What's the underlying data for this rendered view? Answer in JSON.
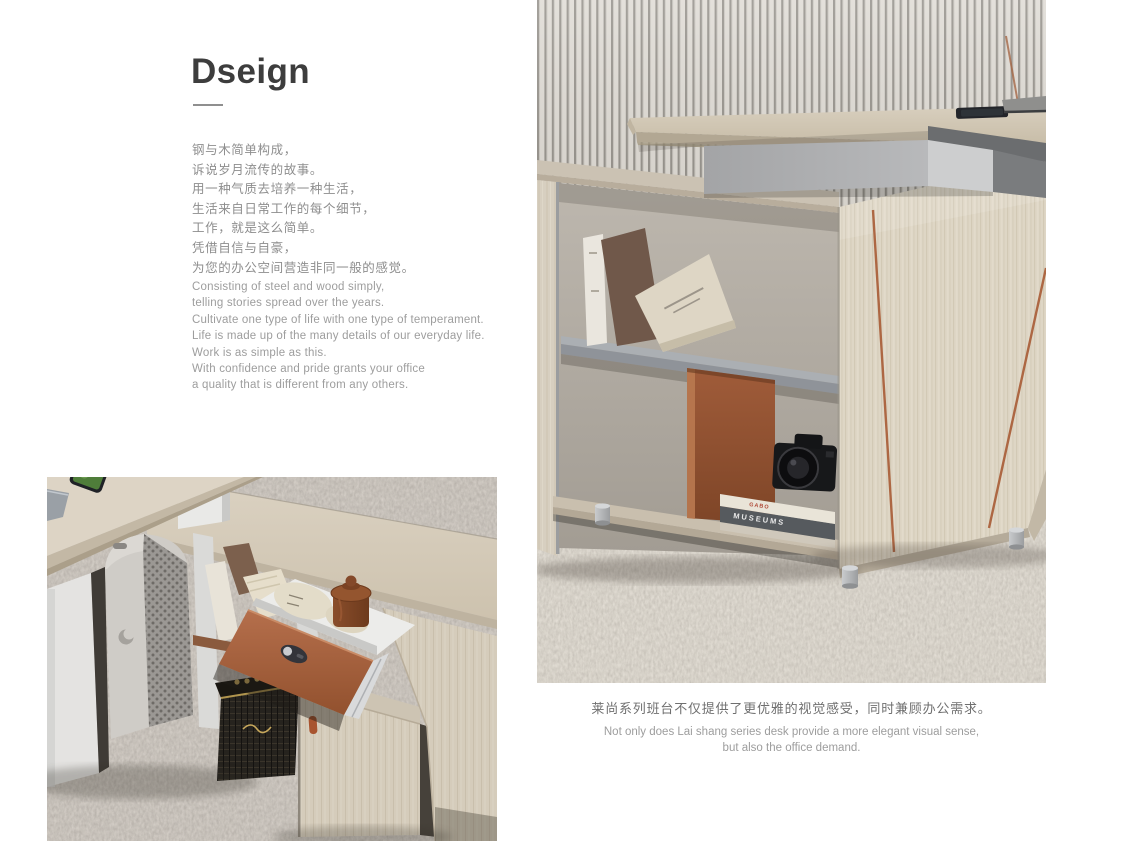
{
  "section": {
    "title": "Dseign",
    "intro_zh": [
      "钢与木简单构成，",
      "诉说岁月流传的故事。",
      "用一种气质去培养一种生活，",
      "生活来自日常工作的每个细节，",
      "工作，就是这么简单。",
      "凭借自信与自豪，",
      "为您的办公空间营造非同一般的感觉。"
    ],
    "intro_en": [
      "Consisting of steel and wood simply,",
      "telling stories spread over the years.",
      "Cultivate one type of life with one type of temperament.",
      "Life is made up of the many details of our everyday life.",
      "Work is as simple as this.",
      "With confidence and pride grants your office",
      "a quality that is different from any others."
    ]
  },
  "caption": {
    "zh": "莱尚系列班台不仅提供了更优雅的视觉感受，同时兼顾办公需求。",
    "en_lines": [
      "Not only does Lai shang series desk provide a more elegant visual sense,",
      "but also the office demand."
    ]
  },
  "photos": {
    "right": {
      "label": "desk side cabinet detail photo",
      "book_spines": {
        "top": "GABO",
        "bottom": "MUSEUMS"
      }
    },
    "left": {
      "label": "desk open drawer detail photo"
    }
  },
  "colors": {
    "accent_copper": "#ad6743",
    "drawer_terracotta": "#b26c49",
    "wood_light": "#d6cdbc",
    "slat_light": "#dcd8d1",
    "slat_dark": "#8b8780",
    "carpet_base": "#a49e95",
    "support_gray": "#a7a8aa",
    "title_text": "#3d3d3d",
    "body_text": "#8e8e8e"
  }
}
